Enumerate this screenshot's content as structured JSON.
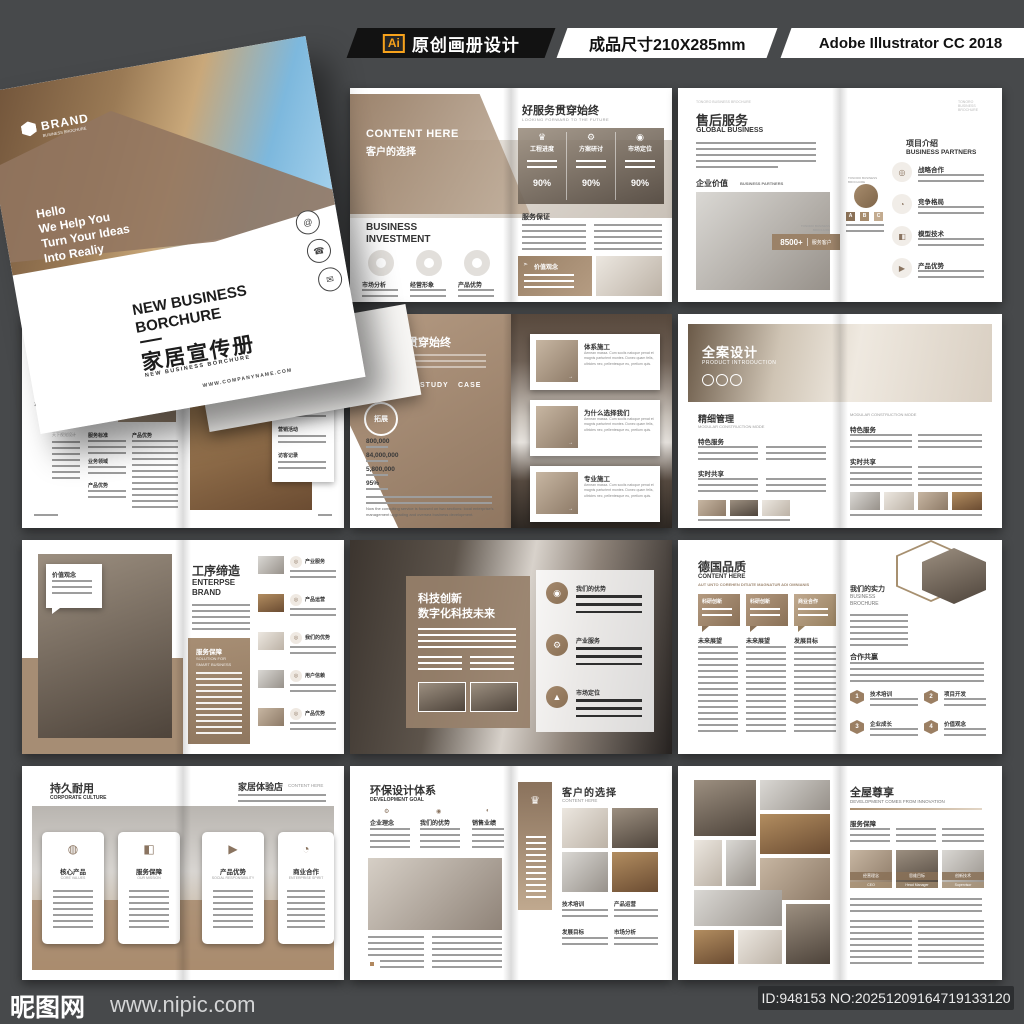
{
  "header": {
    "ai_badge": "Ai",
    "label1": "原创画册设计",
    "label2": "成品尺寸210X285mm",
    "label3": "Adobe Illustrator CC 2018"
  },
  "footer": {
    "site": "昵图网",
    "url": "www.nipic.com",
    "id_text": "ID:948153 NO:20251209164719133120"
  },
  "colors": {
    "accent_brown": "#9b8268",
    "dark_bg": "#47494b",
    "header_black": "#121212",
    "ai_orange": "#f7a21b"
  },
  "cover": {
    "brand": "BRAND",
    "brand_sub": "BUSINESS BROCHURE",
    "tagline": [
      "Hello",
      "We Help You",
      "Turn Your Ideas",
      "Into Realiy"
    ],
    "title1": "NEW BUSINESS",
    "title2": "BORCHURE",
    "title_cn": "家居宣传册",
    "title_sub": "NEW BUSINESS BORCHURE",
    "site": "WWW.COMPANYNAME.COM",
    "contact_icons": [
      "@",
      "☎",
      "✉"
    ]
  },
  "service": {
    "content_here": "CONTENT HERE",
    "subtitle": "客户的选择",
    "invest1": "BUSINESS",
    "invest2": "INVESTMENT",
    "donuts": [
      "市场分析",
      "经营形象",
      "产品优势"
    ],
    "title": "好服务贯穿始终",
    "title_sub": "LOOKING FORWARD TO THE FUTURE",
    "stats": [
      {
        "icon": "♛",
        "label": "工程进度",
        "pct": "90%"
      },
      {
        "icon": "⚙",
        "label": "方案研讨",
        "pct": "90%"
      },
      {
        "icon": "◉",
        "label": "市场定位",
        "pct": "90%"
      }
    ],
    "section": "服务保证",
    "box_label": "价值观念"
  },
  "global": {
    "micro": "TONORO BUSINESS BROCHURE",
    "title": "售后服务",
    "sub": "GLOBAL BUSINESS",
    "section": "企业价值",
    "section_sub": "BUSINESS PARTNERS",
    "badge": "8500+",
    "badge_label": "服务客户",
    "right_title": "项目介绍",
    "right_sub": "BUSINESS PARTNERS",
    "items": [
      {
        "icon": "◎",
        "label": "战略合作"
      },
      {
        "icon": "◔",
        "label": "竞争格局"
      },
      {
        "icon": "◧",
        "label": "模型技术"
      },
      {
        "icon": "▶",
        "label": "产品优势"
      }
    ],
    "abc": [
      "A",
      "B",
      "C"
    ]
  },
  "works": {
    "no": "N°01",
    "vertical": "毕业设计作品册",
    "vertical_sub": "GRADUATION DESIGN WORKS COLLECTION",
    "colA": "天下视觉设计",
    "colB1": "服务标准",
    "colB2": "业务领域",
    "colB3": "产品优势",
    "colC": "产品优势",
    "right_items": [
      "经营方针",
      "营销活动",
      "访客记录"
    ]
  },
  "worker": {
    "title": "好服务贯穿始终",
    "words": [
      "WORKER",
      "STUDY",
      "CASE"
    ],
    "circle": "拓展",
    "stats": [
      "800,000",
      "84,000,000",
      "5,800,000",
      "95%"
    ],
    "para_en": "Now the consulting service is focused on two sections: local enterprise's management upgrading and oversea business development.",
    "cards": [
      {
        "title": "体系施工",
        "text": "Aenean massa. Cum sociis natoque penat et magnis parturient montes. Donec quam felis, ultricies nec, pellentesque eu, pretium quis."
      },
      {
        "title": "为什么选择我们",
        "text": "Aenean massa. Cum sociis natoque penat et magnis parturient montes. Donec quam felis, ultricies nec, pellentesque eu, pretium quis."
      },
      {
        "title": "专业施工",
        "text": "Aenean massa. Cum sociis natoque penat et magnis parturient montes. Donec quam felis, ultricies nec, pellentesque eu, pretium quis."
      }
    ]
  },
  "product": {
    "hero": "全案设计",
    "hero_sub": "PRODUCT INTRODUCTION",
    "left_title": "精细管理",
    "left_sub": "MODULAR CONSTRUCTION MODE",
    "sec1": "特色服务",
    "sec2": "实时共享",
    "right_sub": "MODULAR CONSTRUCTION MODE",
    "rsec1": "特色服务",
    "rsec2": "实时共享"
  },
  "enterprise": {
    "bubble": "价值观念",
    "title": "工序缔造",
    "sub1": "ENTERPSE",
    "sub2": "BRAND",
    "brown_title": "服务保障",
    "brown_sub1": "SOLUTION FOR",
    "brown_sub2": "SMART BUSINESS",
    "items": [
      "产业服务",
      "产品运营",
      "我们的优势",
      "用户信赖",
      "产品优势"
    ]
  },
  "tech": {
    "title1": "科技创新",
    "title2": "数字化科技未来",
    "items": [
      {
        "icon": "◉",
        "label": "我们的优势"
      },
      {
        "icon": "⚙",
        "label": "产业服务"
      },
      {
        "icon": "▲",
        "label": "市场定位"
      }
    ]
  },
  "quality": {
    "title": "德国品质",
    "sub1": "CONTENT HERE",
    "sub2": "AUT UNTO COREHEN DITIATE MAGNATUR ADI OMNIANIS",
    "bubbles": [
      "科研创新",
      "科研创新",
      "商业合作"
    ],
    "cols": [
      "未来展望",
      "未来展望",
      "发展目标"
    ],
    "right_title": "我们的实力",
    "right_sub1": "BUSINESS",
    "right_sub2": "BROCHURE",
    "coop": "合作共赢",
    "nums": [
      {
        "n": "1",
        "label": "技术培训"
      },
      {
        "n": "2",
        "label": "项目开发"
      },
      {
        "n": "3",
        "label": "企业成长"
      },
      {
        "n": "4",
        "label": "价值观念"
      }
    ]
  },
  "culture": {
    "title": "持久耐用",
    "sub": "CORPORATE CULTURE",
    "rtitle": "家居体验店",
    "rsub": "CONTENT HERE",
    "cards": [
      {
        "icon": "◍",
        "cn": "核心产品",
        "en": "CORE VALUES"
      },
      {
        "icon": "◧",
        "cn": "服务保障",
        "en": "OUR MISSION"
      },
      {
        "icon": "▶",
        "cn": "产品优势",
        "en": "SOCIAL RESPONSIBILITY"
      },
      {
        "icon": "◔",
        "cn": "商业合作",
        "en": "ENTERPRISE SPIRIT"
      }
    ]
  },
  "eco": {
    "title": "环保设计体系",
    "sub": "DEVELOPMENT GOAL",
    "cols": [
      {
        "icon": "⚙",
        "label": "企业理念"
      },
      {
        "icon": "◉",
        "label": "我们的优势"
      },
      {
        "icon": "◐",
        "label": "销售业绩"
      }
    ],
    "trophy": "♛",
    "rtitle": "客户的选择",
    "rsub": "CONTENT HERE",
    "labels": [
      "技术培训",
      "产品运营",
      "发展目标",
      "市场分析"
    ]
  },
  "whole": {
    "title": "全屋尊享",
    "sub": "DEVELOPMENT COMES FROM INNOVATION",
    "section": "服务保障",
    "caps": [
      {
        "cn": "经营理念",
        "en": "CEO"
      },
      {
        "cn": "思维目标",
        "en": "Head Manager"
      },
      {
        "cn": "创新技术",
        "en": "Supervisor"
      }
    ]
  }
}
